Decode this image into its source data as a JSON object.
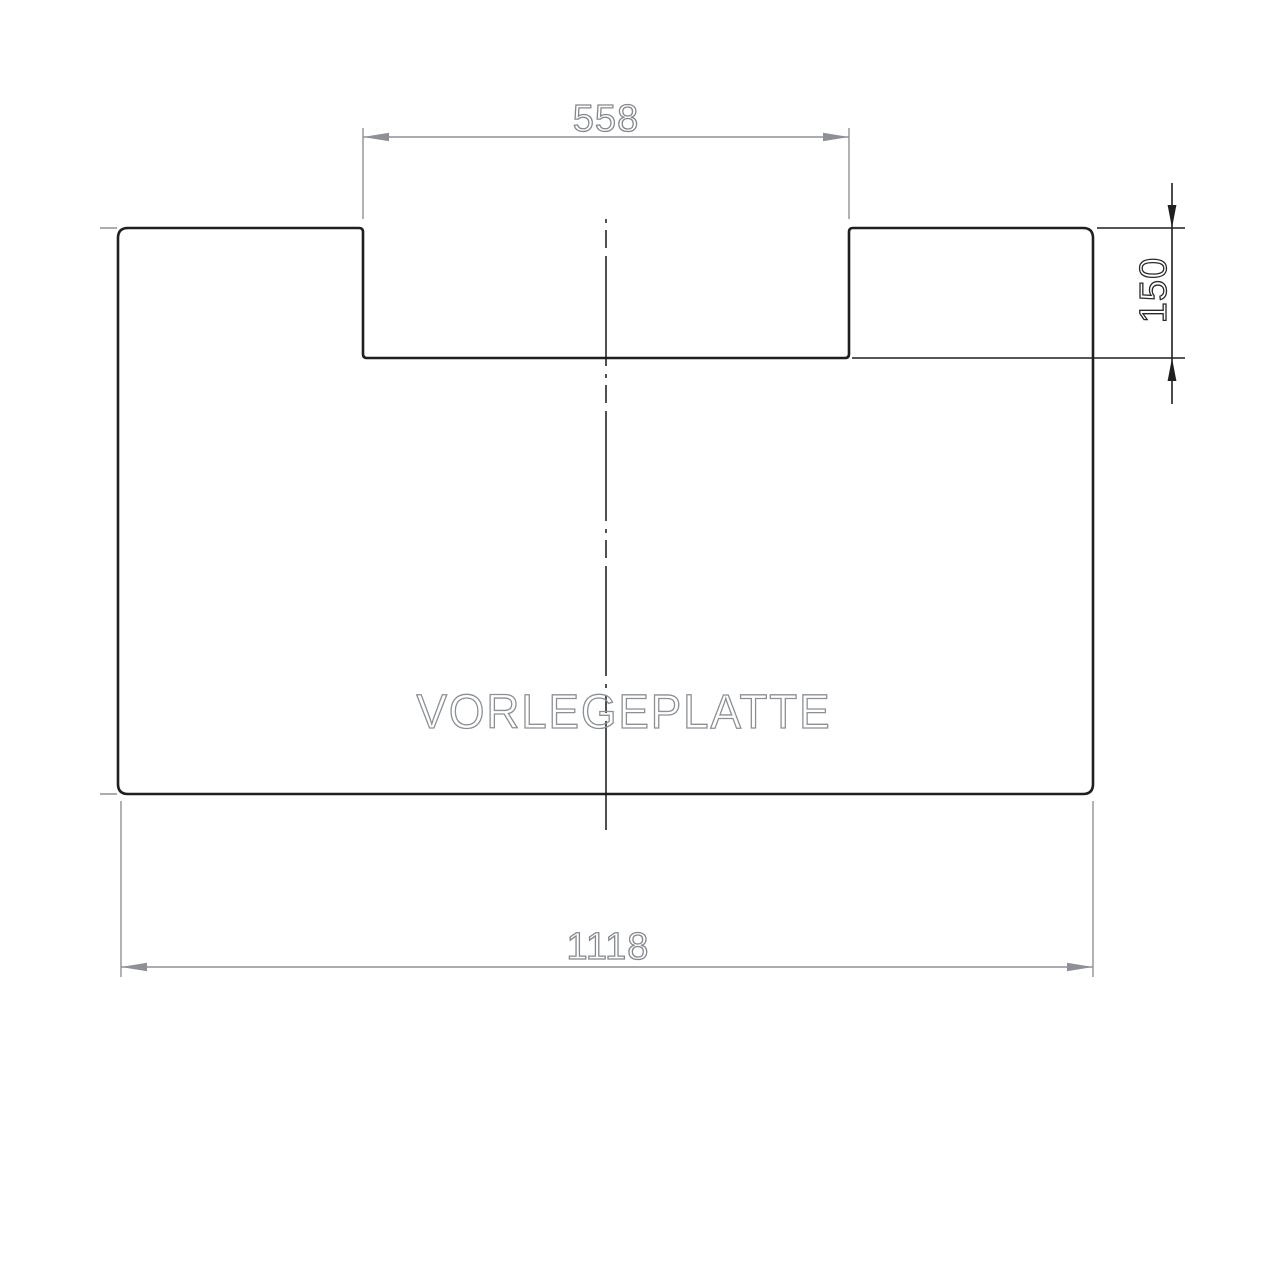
{
  "drawing": {
    "part_label": "VORLEGEPLATTE",
    "dimensions": {
      "top_notch_width": "558",
      "right_notch_depth": "150",
      "bottom_overall_width": "1118"
    },
    "colors": {
      "outline": "#1f1f1f",
      "dimension_secondary": "#8d9197",
      "dimension_primary": "#1f1f1f",
      "label_gray": "#8b9096"
    }
  }
}
